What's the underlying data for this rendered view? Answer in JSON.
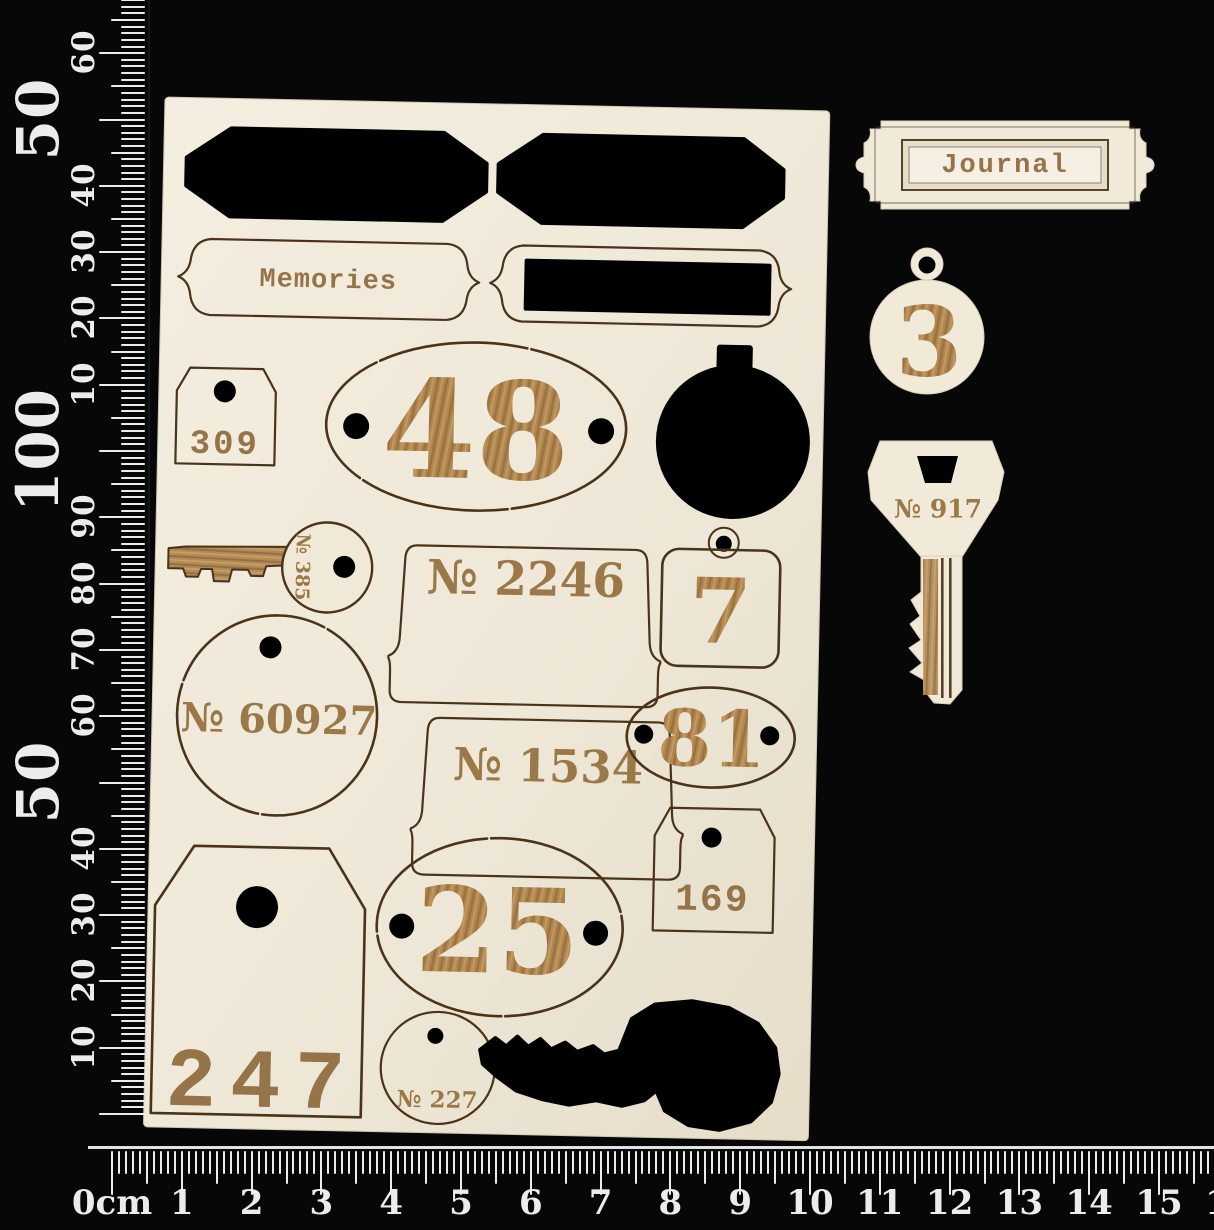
{
  "colors": {
    "background": "#070707",
    "sheet": "#efe8d8",
    "piece": "#f1ead9",
    "cut_line": "#4a3319",
    "engraving_text": "#96744a",
    "engraving_number": "#ab8352",
    "cutout_black": "#000000",
    "ruler_markings": "#ececec"
  },
  "rulers": {
    "vertical": {
      "labels": [
        {
          "text": "60",
          "mm": 160,
          "big": false
        },
        {
          "text": "50",
          "mm": 150,
          "big": true
        },
        {
          "text": "40",
          "mm": 140,
          "big": false
        },
        {
          "text": "30",
          "mm": 130,
          "big": false
        },
        {
          "text": "20",
          "mm": 120,
          "big": false
        },
        {
          "text": "10",
          "mm": 110,
          "big": false
        },
        {
          "text": "100",
          "mm": 100,
          "big": true
        },
        {
          "text": "90",
          "mm": 90,
          "big": false
        },
        {
          "text": "80",
          "mm": 80,
          "big": false
        },
        {
          "text": "70",
          "mm": 70,
          "big": false
        },
        {
          "text": "60",
          "mm": 60,
          "big": false
        },
        {
          "text": "50",
          "mm": 50,
          "big": true
        },
        {
          "text": "40",
          "mm": 40,
          "big": false
        },
        {
          "text": "30",
          "mm": 30,
          "big": false
        },
        {
          "text": "20",
          "mm": 20,
          "big": false
        },
        {
          "text": "10",
          "mm": 10,
          "big": false
        }
      ]
    },
    "horizontal": {
      "labels": [
        {
          "text": "0cm",
          "cm": 0
        },
        {
          "text": "1",
          "cm": 1
        },
        {
          "text": "2",
          "cm": 2
        },
        {
          "text": "3",
          "cm": 3
        },
        {
          "text": "4",
          "cm": 4
        },
        {
          "text": "5",
          "cm": 5
        },
        {
          "text": "6",
          "cm": 6
        },
        {
          "text": "7",
          "cm": 7
        },
        {
          "text": "8",
          "cm": 8
        },
        {
          "text": "9",
          "cm": 9
        },
        {
          "text": "10",
          "cm": 10
        },
        {
          "text": "11",
          "cm": 11
        },
        {
          "text": "12",
          "cm": 12
        },
        {
          "text": "13",
          "cm": 13
        },
        {
          "text": "14",
          "cm": 14
        },
        {
          "text": "15",
          "cm": 15
        },
        {
          "text": "16",
          "cm": 16
        }
      ]
    }
  },
  "sheet": {
    "pieces": {
      "memories_label": "Memories",
      "tag_309": "309",
      "plate_48": "48",
      "label_2246": "№ 2246",
      "tag_7": "7",
      "key_385": "№ 385",
      "tag_60927": "№ 60927",
      "label_1534": "№ 1534",
      "plate_81": "81",
      "plate_25": "25",
      "tag_169": "169",
      "tag_247": "247",
      "tag_227": "№ 227"
    }
  },
  "loose_pieces": {
    "journal_plate": "Journal",
    "tag_3": "3",
    "key_917": "№ 917"
  }
}
